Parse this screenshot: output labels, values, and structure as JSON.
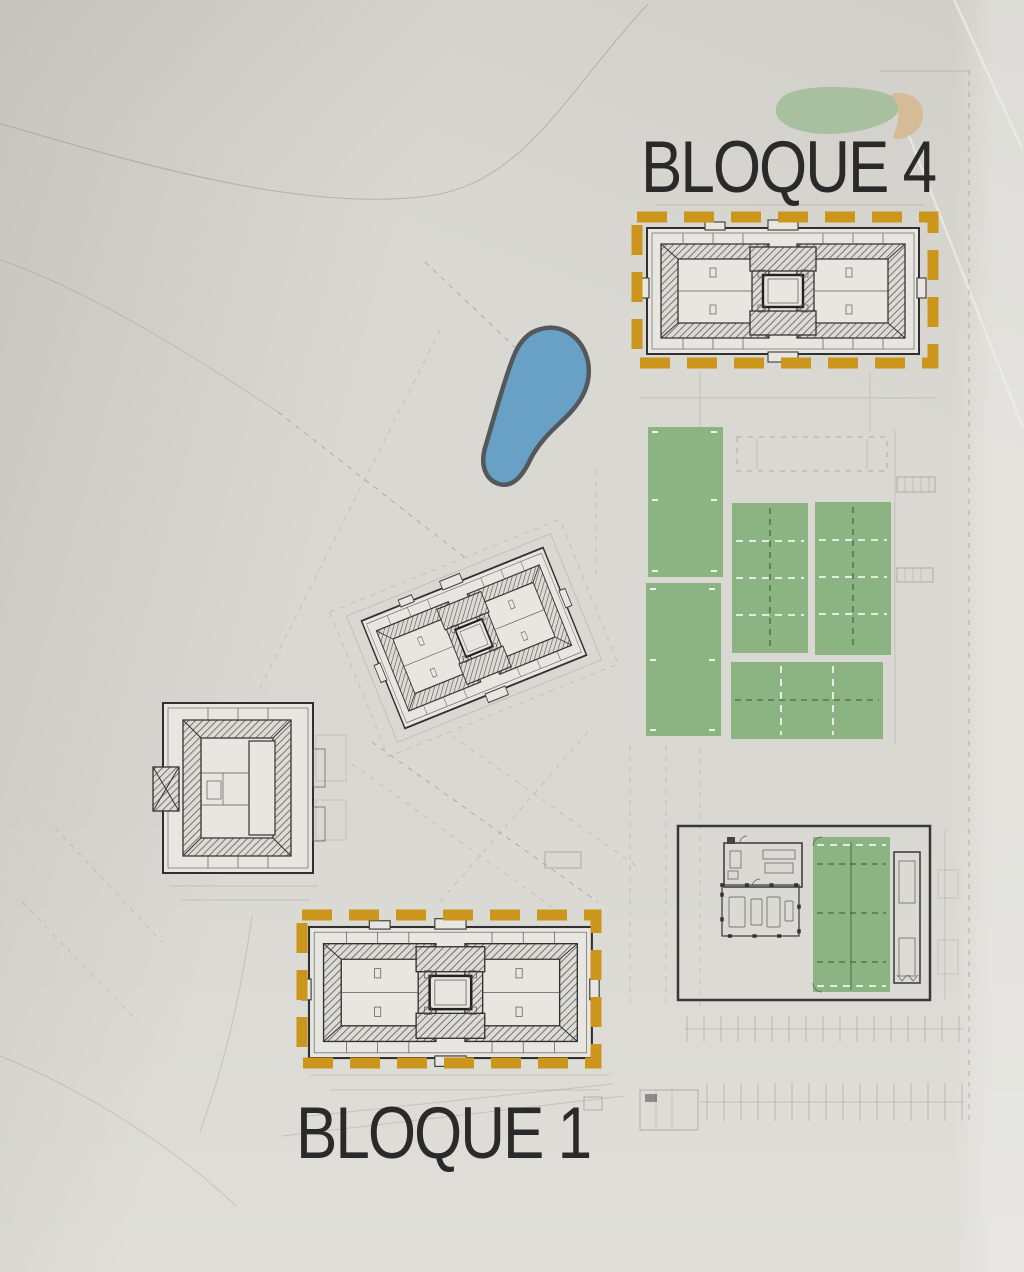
{
  "labels": {
    "bloque4": "BLOQUE 4",
    "bloque1": "BLOQUE 1"
  },
  "highlighted_blocks": [
    "BLOQUE 4",
    "BLOQUE 1"
  ],
  "colors": {
    "paper": "#d9d8d2",
    "ink": "#2a2a2a",
    "highlight_orange": "#cc951c",
    "court_green": "#8cb482",
    "pond_blue": "#69a0c6",
    "vegetation_green": "#a8bfa0",
    "sand_tan": "#d6bb97"
  }
}
